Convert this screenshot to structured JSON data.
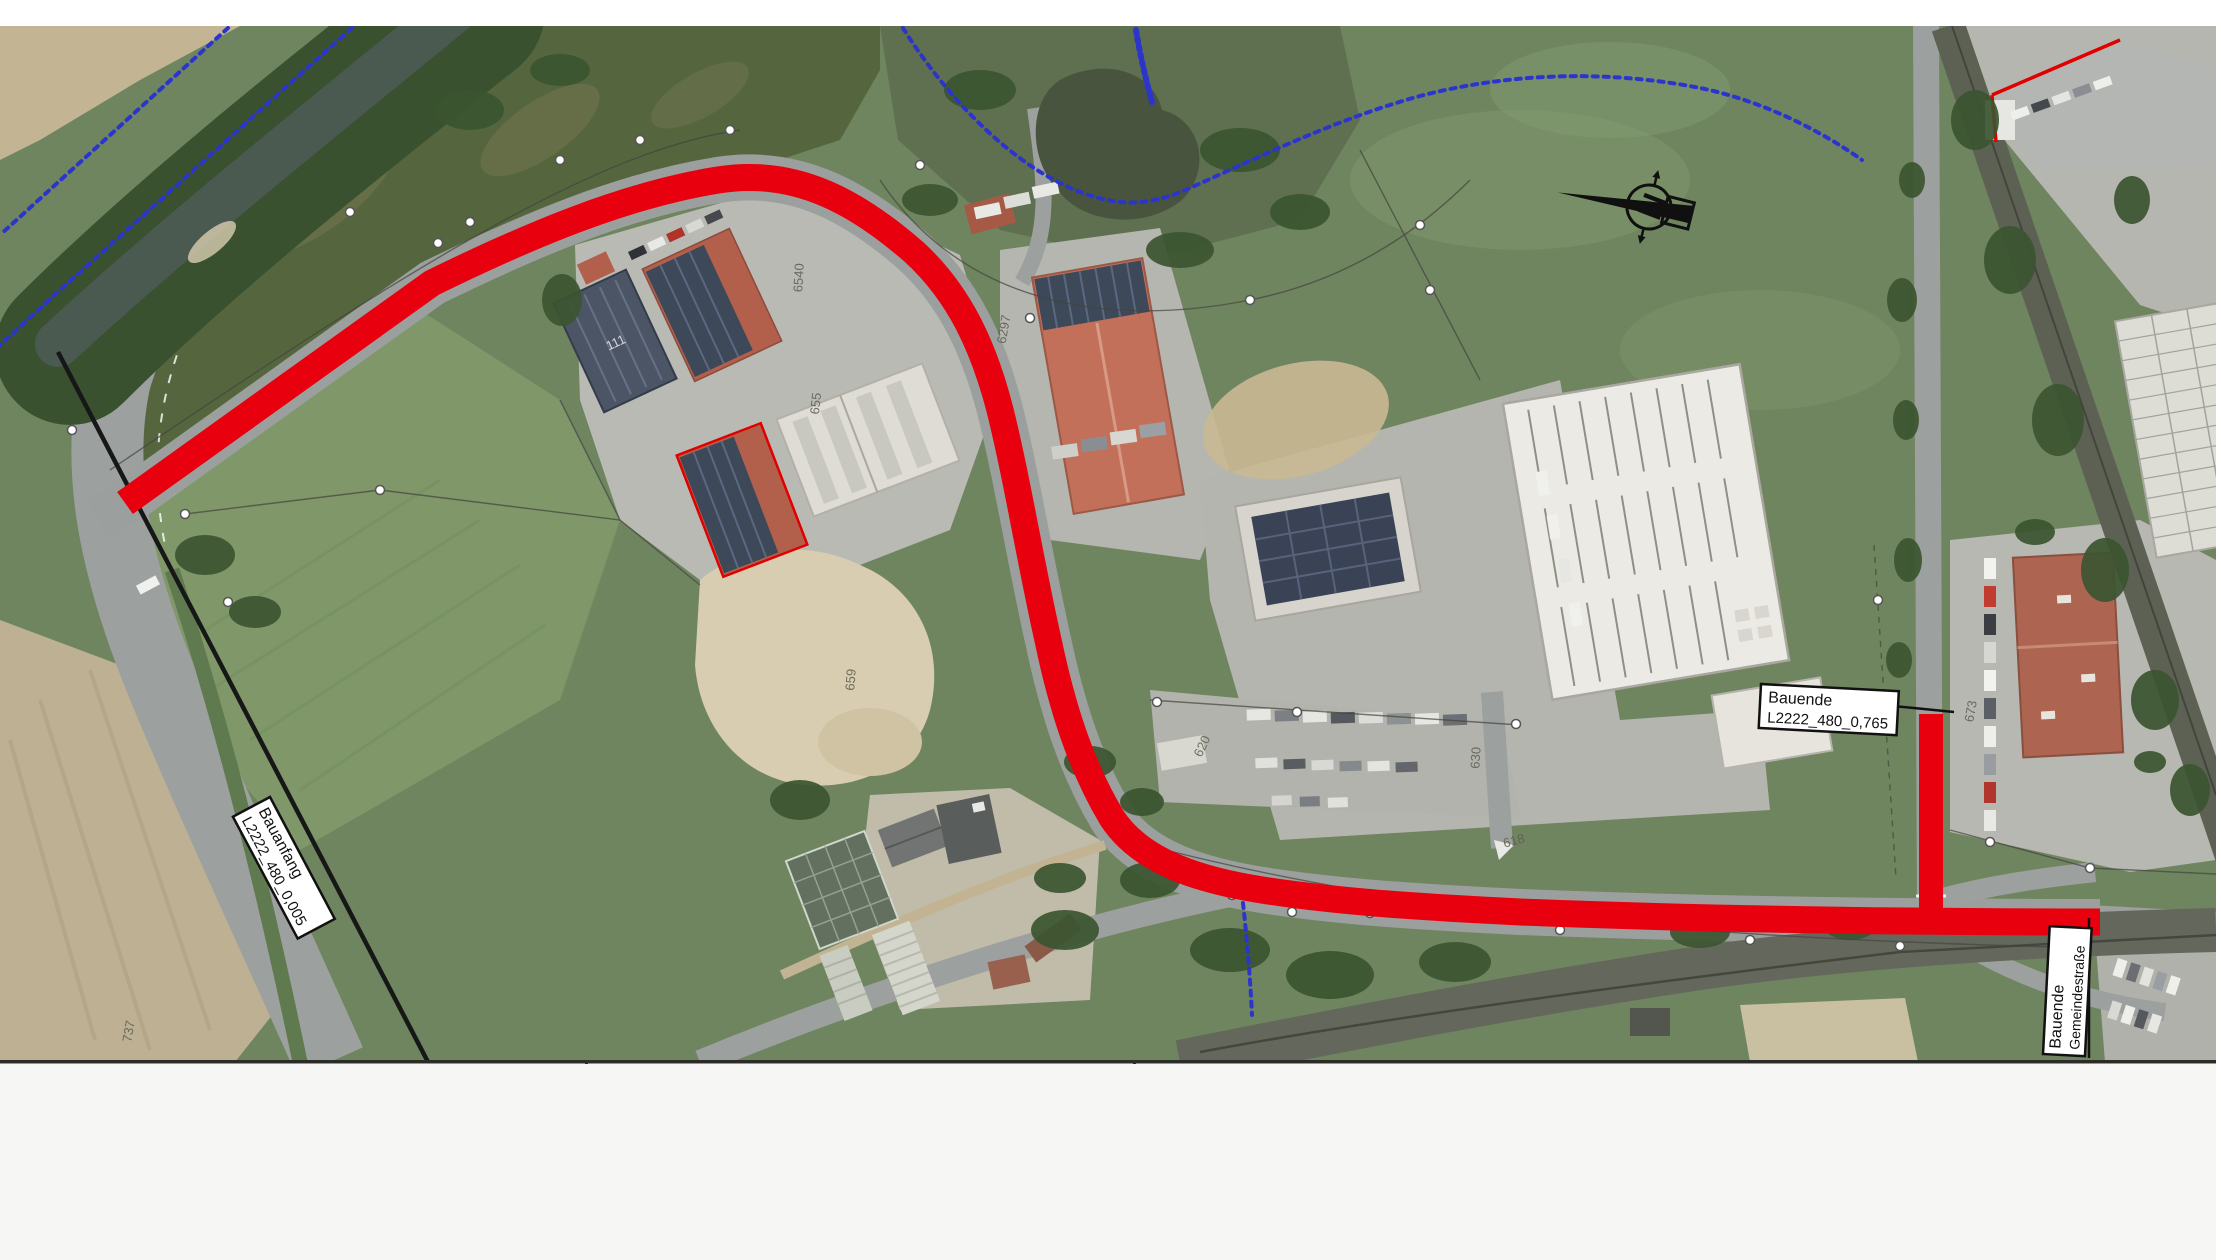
{
  "document": {
    "type": "construction-site-plan-on-aerial-photo",
    "labels": {
      "construction_start": {
        "line1": "Bauanfang",
        "line2": "L2222_480_0,005"
      },
      "construction_end_road": {
        "line1": "Bauende",
        "line2": "L2222_480_0,765"
      },
      "construction_end_municipal": {
        "line1": "Bauende",
        "line2": "Gemeindestraße"
      }
    },
    "north_arrow_letter": "N",
    "parcel_numbers": {
      "p737": "737",
      "p655": "655",
      "p6540": "6540",
      "p6297": "6297",
      "p659": "659",
      "p673": "673",
      "p620": "620",
      "p630": "630",
      "p618": "618",
      "p111": "111"
    },
    "colors": {
      "route_red": "#e8000f",
      "boundary_blue": "#2b35cc",
      "label_background": "#ffffff",
      "label_border": "#111111",
      "map_border": "#2b2b28",
      "margin": "#ffffff"
    }
  }
}
